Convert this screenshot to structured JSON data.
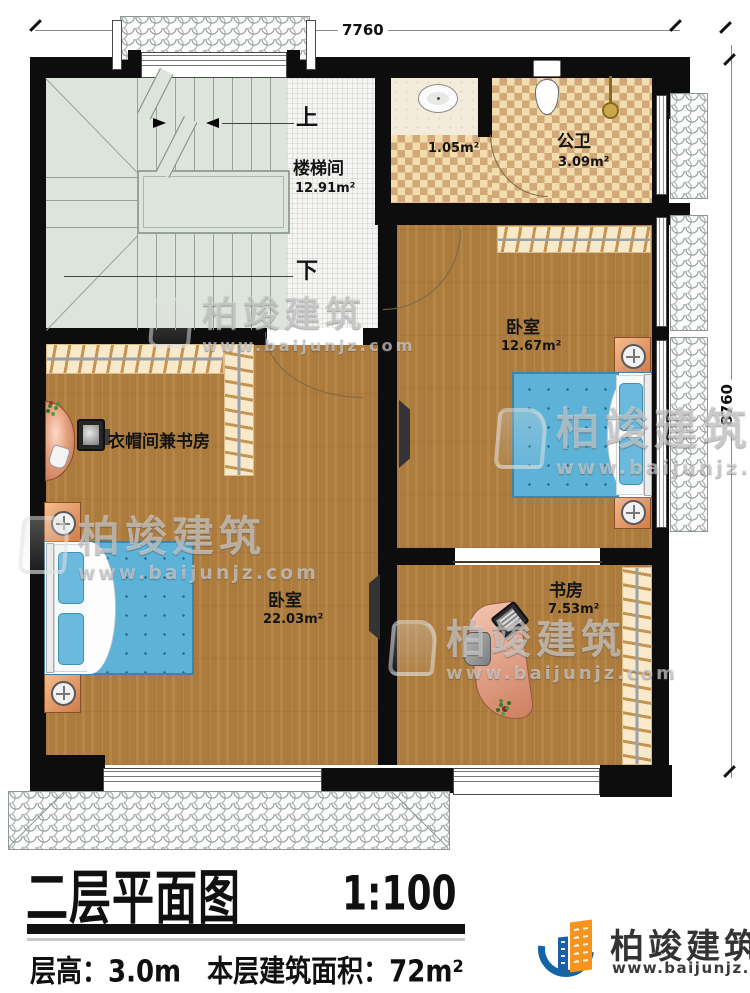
{
  "plan": {
    "dimensions": {
      "width_mm": "7760",
      "height_mm": "8760"
    },
    "stairs": {
      "up_label": "上",
      "down_label": "下"
    },
    "rooms": {
      "stairwell": {
        "name": "楼梯间",
        "area": "12.91m²"
      },
      "corridor": {
        "area": "1.05m²"
      },
      "bathroom": {
        "name": "公卫",
        "area": "3.09m²"
      },
      "bedroom_right": {
        "name": "卧室",
        "area": "12.67m²"
      },
      "cloakroom_study": {
        "name": "衣帽间兼书房"
      },
      "bedroom_left": {
        "name": "卧室",
        "area": "22.03m²"
      },
      "study": {
        "name": "书房",
        "area": "7.53m²"
      }
    }
  },
  "watermark": {
    "brand": "柏竣建筑",
    "url": "www.baijunjz.com"
  },
  "footer": {
    "title": "二层平面图",
    "scale": "1:100",
    "info": "层高：3.0m　本层建筑面积：72m²",
    "logo_brand": "柏竣建筑",
    "logo_url": "www.baijunjz.com"
  },
  "colors": {
    "wall": "#0d0d0d",
    "wood_floor": "#ad7b3c",
    "stair_floor": "#dde4db",
    "tile_light": "#f2ddae",
    "tile_dark": "#d2a876",
    "bed_blue": "#5db2d8",
    "nightstand_orange": "#e09055",
    "logo_orange": "#f7941d",
    "logo_blue": "#1464a8"
  }
}
